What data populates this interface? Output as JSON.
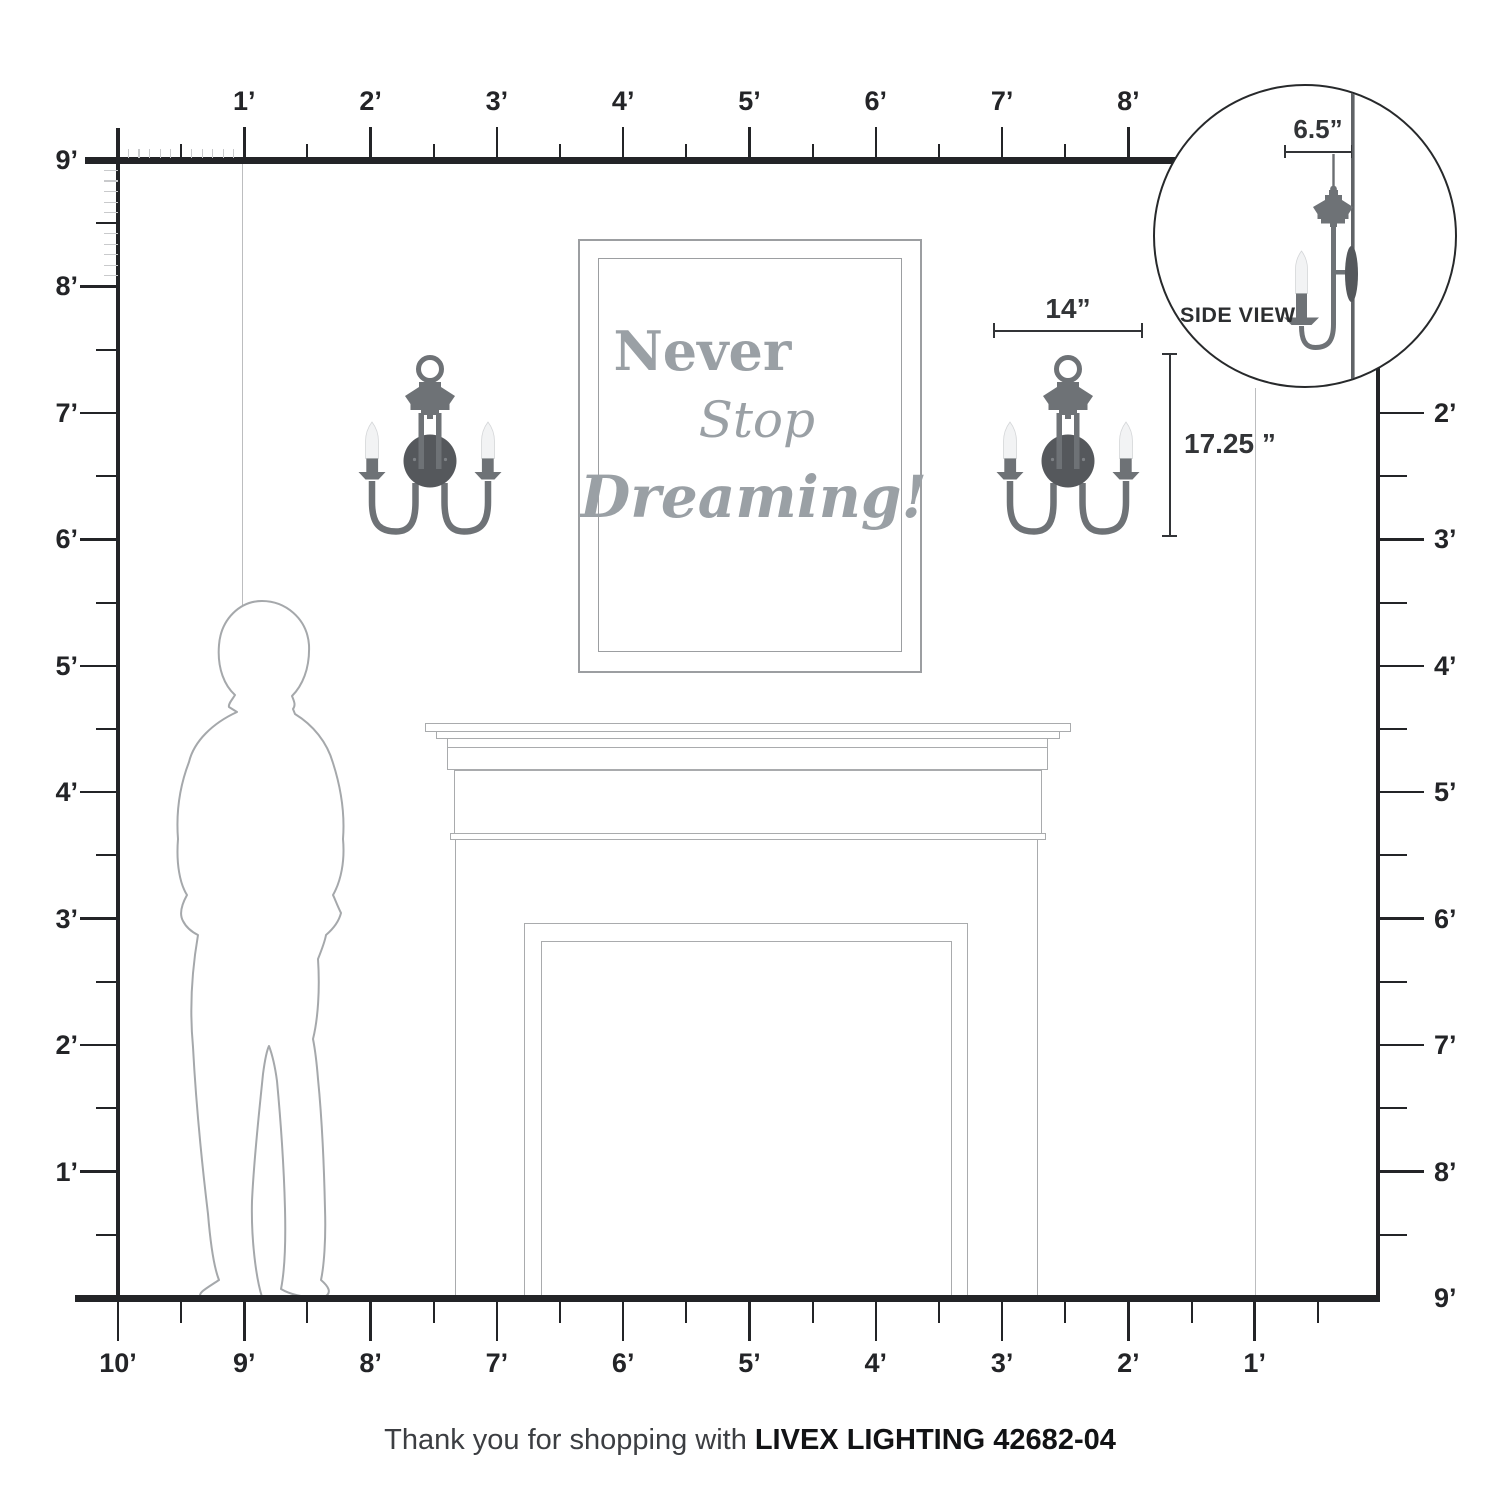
{
  "annotations": {
    "width_label": "14”",
    "height_label": "17.25 ”",
    "depth_label": "6.5”",
    "side_view_label": "SIDE VIEW"
  },
  "artwork": {
    "line1": "Never",
    "line2": "Stop",
    "line3": "Dreaming!"
  },
  "rulers": {
    "top_labels": [
      "1’",
      "2’",
      "3’",
      "4’",
      "5’",
      "6’",
      "7’",
      "8’"
    ],
    "left_labels": [
      "9’",
      "8’",
      "7’",
      "6’",
      "5’",
      "4’",
      "3’",
      "2’",
      "1’"
    ],
    "right_labels": [
      "2’",
      "3’",
      "4’",
      "5’",
      "6’",
      "7’",
      "8’",
      "9’"
    ],
    "bottom_labels": [
      "10’",
      "9’",
      "8’",
      "7’",
      "6’",
      "5’",
      "4’",
      "3’",
      "2’",
      "1’"
    ]
  },
  "footer": {
    "prefix": "Thank you for shopping with",
    "brand": "LIVEX LIGHTING 42682-04"
  },
  "colors": {
    "sconce_body": "#6e7276",
    "sconce_backplate": "#55585c",
    "candle": "#f2f3f4",
    "artwork_text": "#9aa0a5",
    "ruler_dark": "#232427",
    "outline_gray": "#a9abad",
    "faint_line": "#bcbdbf",
    "dimension": "#323437"
  }
}
